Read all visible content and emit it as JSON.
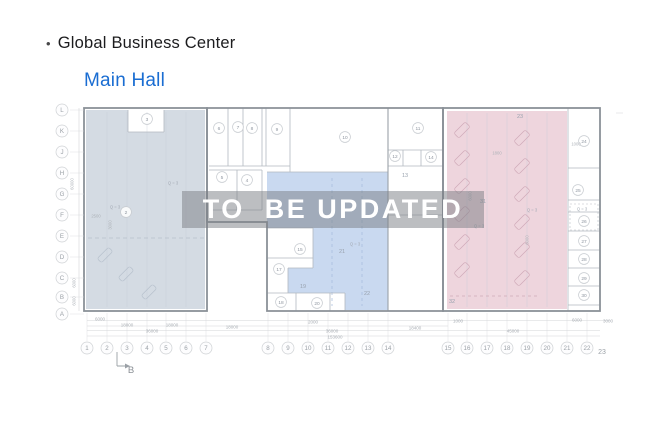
{
  "header": {
    "bullet": "•",
    "title": "Global Business Center",
    "subtitle": "Main Hall"
  },
  "watermark": {
    "text": "TO  BE UPDATED"
  },
  "colors": {
    "accent_blue": "#1a6dd2",
    "title_text": "#1c1c1e",
    "zone_left": "#d4dbe3",
    "zone_middle": "#c9d9f0",
    "zone_right": "#eed5dd",
    "watermark_bg": "rgba(122,126,132,0.5)",
    "watermark_text": "#ffffff",
    "wall_heavy": "#8b9198",
    "wall_light": "#b3b9c0"
  },
  "plan": {
    "rows": [
      {
        "label": "L",
        "y": 110
      },
      {
        "label": "K",
        "y": 131
      },
      {
        "label": "J",
        "y": 152
      },
      {
        "label": "H",
        "y": 173
      },
      {
        "label": "G",
        "y": 194
      },
      {
        "label": "F",
        "y": 215
      },
      {
        "label": "E",
        "y": 236
      },
      {
        "label": "D",
        "y": 257
      },
      {
        "label": "C",
        "y": 278
      },
      {
        "label": "B",
        "y": 297
      },
      {
        "label": "A",
        "y": 314
      }
    ],
    "cols": [
      {
        "label": "1",
        "x": 87
      },
      {
        "label": "2",
        "x": 107
      },
      {
        "label": "3",
        "x": 127
      },
      {
        "label": "4",
        "x": 147
      },
      {
        "label": "5",
        "x": 166
      },
      {
        "label": "6",
        "x": 186
      },
      {
        "label": "7",
        "x": 206
      },
      {
        "label": "8",
        "x": 268
      },
      {
        "label": "9",
        "x": 288
      },
      {
        "label": "10",
        "x": 308
      },
      {
        "label": "11",
        "x": 328
      },
      {
        "label": "12",
        "x": 348
      },
      {
        "label": "13",
        "x": 368
      },
      {
        "label": "14",
        "x": 388
      },
      {
        "label": "15",
        "x": 448
      },
      {
        "label": "16",
        "x": 467
      },
      {
        "label": "17",
        "x": 487
      },
      {
        "label": "18",
        "x": 507
      },
      {
        "label": "19",
        "x": 527
      },
      {
        "label": "20",
        "x": 547
      },
      {
        "label": "21",
        "x": 567
      },
      {
        "label": "22",
        "x": 587
      }
    ],
    "col_end": {
      "label": "23",
      "x": 602,
      "y": 354
    },
    "rooms_circled": [
      {
        "n": "3",
        "x": 147,
        "y": 119
      },
      {
        "n": "6",
        "x": 219,
        "y": 128
      },
      {
        "n": "7",
        "x": 238,
        "y": 127
      },
      {
        "n": "8",
        "x": 252,
        "y": 128
      },
      {
        "n": "9",
        "x": 277,
        "y": 129
      },
      {
        "n": "10",
        "x": 345,
        "y": 137
      },
      {
        "n": "11",
        "x": 418,
        "y": 128
      },
      {
        "n": "12",
        "x": 395,
        "y": 156
      },
      {
        "n": "14",
        "x": 431,
        "y": 157
      },
      {
        "n": "5",
        "x": 222,
        "y": 177
      },
      {
        "n": "4",
        "x": 247,
        "y": 180
      },
      {
        "n": "2",
        "x": 126,
        "y": 212
      },
      {
        "n": "15",
        "x": 300,
        "y": 249
      },
      {
        "n": "17",
        "x": 279,
        "y": 269
      },
      {
        "n": "18",
        "x": 281,
        "y": 302
      },
      {
        "n": "20",
        "x": 317,
        "y": 303
      },
      {
        "n": "24",
        "x": 584,
        "y": 141
      },
      {
        "n": "25",
        "x": 578,
        "y": 190
      },
      {
        "n": "26",
        "x": 584,
        "y": 221
      },
      {
        "n": "27",
        "x": 584,
        "y": 241
      },
      {
        "n": "28",
        "x": 584,
        "y": 259
      },
      {
        "n": "29",
        "x": 584,
        "y": 278
      },
      {
        "n": "30",
        "x": 584,
        "y": 295
      }
    ],
    "rooms_plain": [
      {
        "n": "13",
        "x": 405,
        "y": 175
      },
      {
        "n": "19",
        "x": 303,
        "y": 286
      },
      {
        "n": "21",
        "x": 342,
        "y": 251
      },
      {
        "n": "22",
        "x": 367,
        "y": 293
      },
      {
        "n": "23",
        "x": 520,
        "y": 116
      },
      {
        "n": "31",
        "x": 483,
        "y": 201
      },
      {
        "n": "32",
        "x": 452,
        "y": 301
      }
    ],
    "q_label": "Q = 3",
    "q_positions": [
      {
        "x": 173,
        "y": 183
      },
      {
        "x": 115,
        "y": 207
      },
      {
        "x": 355,
        "y": 244
      },
      {
        "x": 532,
        "y": 210
      },
      {
        "x": 479,
        "y": 226
      },
      {
        "x": 582,
        "y": 209
      }
    ],
    "misc_texts": [
      {
        "t": "2500",
        "x": 96,
        "y": 216
      },
      {
        "t": "1800",
        "x": 497,
        "y": 153
      },
      {
        "t": "1000",
        "x": 576,
        "y": 144
      },
      {
        "t": "3000",
        "x": 110,
        "y": 225,
        "rot": -90
      },
      {
        "t": "6000",
        "x": 470,
        "y": 196,
        "rot": -90
      },
      {
        "t": "6000",
        "x": 527,
        "y": 240,
        "rot": -90
      }
    ],
    "left_dims": [
      {
        "t": "60000",
        "x": 72,
        "y": 184,
        "rot": -90
      },
      {
        "t": "6000",
        "x": 74,
        "y": 283,
        "rot": -90
      },
      {
        "t": "6000",
        "x": 74,
        "y": 301,
        "rot": -90
      }
    ],
    "bottom_dims": [
      {
        "t": "6000",
        "x": 100,
        "y": 319
      },
      {
        "t": "18000",
        "x": 127,
        "y": 325
      },
      {
        "t": "18000",
        "x": 172,
        "y": 325
      },
      {
        "t": "36000",
        "x": 152,
        "y": 331
      },
      {
        "t": "18000",
        "x": 232,
        "y": 327
      },
      {
        "t": "2000",
        "x": 313,
        "y": 322
      },
      {
        "t": "36000",
        "x": 332,
        "y": 331
      },
      {
        "t": "153600",
        "x": 335,
        "y": 337
      },
      {
        "t": "18400",
        "x": 415,
        "y": 328
      },
      {
        "t": "1000",
        "x": 458,
        "y": 321
      },
      {
        "t": "45000",
        "x": 513,
        "y": 331
      },
      {
        "t": "6000",
        "x": 577,
        "y": 320
      },
      {
        "t": "3000",
        "x": 608,
        "y": 321
      }
    ],
    "section_marker": {
      "label": "B",
      "x": 131,
      "y": 373
    }
  }
}
